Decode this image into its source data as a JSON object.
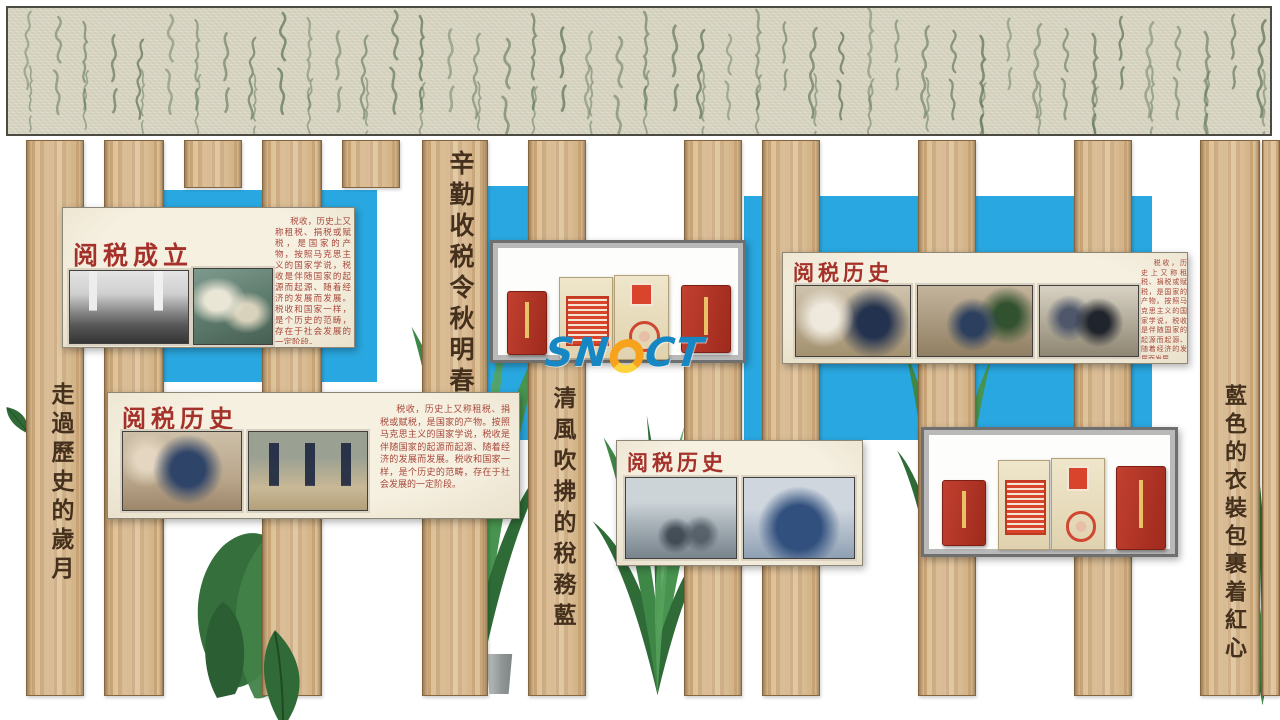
{
  "brand": {
    "logo_text": "SNQCT",
    "logo_left": "SN",
    "logo_right": "CT"
  },
  "colors": {
    "blue_accent": "#29a7e0",
    "wood": "#cfae80",
    "panel_background": "#f1ead9",
    "title_red": "#a5322a",
    "banner_paper": "#d8d5c2",
    "calligraphy_green": "#5e7457",
    "book_red": "#b5372a",
    "logo_blue": "#1687c3",
    "logo_orange": "#f6a21c"
  },
  "plank_texts": [
    {
      "id": "diligent-tax",
      "text": "辛勤收税令秋明春"
    },
    {
      "id": "history-years",
      "text": "走過歷史的歲月"
    },
    {
      "id": "breeze-tax-blue",
      "text": "清風吹拂的稅務藍"
    },
    {
      "id": "blue-uniform-red-heart",
      "text": "藍色的衣裝包裹着紅心"
    }
  ],
  "panels": {
    "establish": {
      "title": "阅税成立",
      "body": "税收，历史上又称租税、捐税或赋税，是国家的产物，按照马克思主义的国家学说，税收是伴随国家的起源而起源、随着经济的发展而发展。税收和国家一样，是个历史的范畴，存在于社会发展的一定阶段。",
      "photos": [
        "bw-founding-group-photo",
        "officers-outdoor-photo"
      ]
    },
    "history_left": {
      "title": "阅税历史",
      "body": "税收，历史上又称租税、捐税或赋税，是国家的产物。按照马克思主义的国家学说，税收是伴随国家的起源而起源、随着经济的发展而发展。税收和国家一样，是个历史的范畴，存在于社会发展的一定阶段。",
      "photos": [
        "officer-with-papers-photo",
        "officers-marching-photo"
      ]
    },
    "history_right": {
      "title": "阅税历史",
      "body": "税收，历史上又称租税、捐税或赋税，是国家的产物。按照马克思主义的国家学说，税收是伴随国家的起源而起源、随着经济的发展而发展。",
      "photos": [
        "office-counter-photo",
        "office-desks-photo",
        "meeting-crowd-photo"
      ]
    },
    "history_bottom": {
      "title": "阅税历史",
      "photos": [
        "bicycle-brigade-photo",
        "group-blue-uniform-photo"
      ]
    }
  },
  "display_cases": {
    "center": {
      "items": [
        "red-book",
        "stamped-document",
        "sealed-document",
        "red-book"
      ]
    },
    "right": {
      "items": [
        "red-book",
        "stamped-document",
        "sealed-document",
        "red-book"
      ]
    }
  }
}
